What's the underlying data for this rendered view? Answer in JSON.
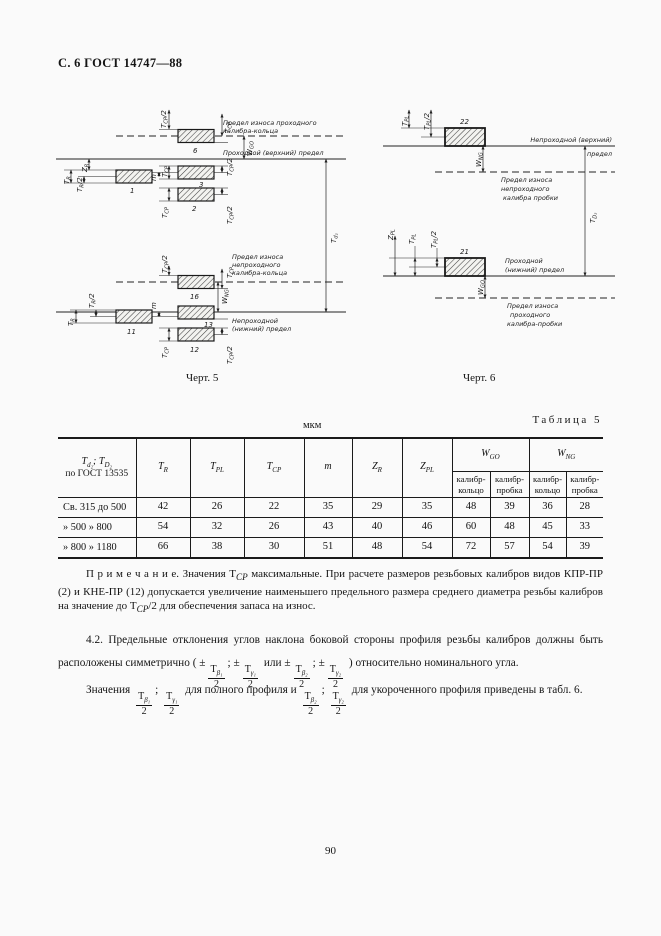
{
  "page": {
    "header": "С. 6 ГОСТ 14747—88",
    "page_number": "90"
  },
  "dims": {
    "T": "T",
    "Z": "Z",
    "W": "W",
    "m": "m",
    "R": "R",
    "PL": "PL",
    "CP": "CP",
    "GO": "GO",
    "NG": "NG",
    "d2": "d₂",
    "D2": "D₂",
    "half": "/2"
  },
  "fig5": {
    "caption": "Черт. 5",
    "wear_go_ring": [
      "Предел износа проходного",
      "калибра-кольца"
    ],
    "go_upper": "Проходной (верхний) предел",
    "wear_ng_ring": [
      "Предел износа",
      "непроходного",
      "калибра-кольца"
    ],
    "ng_lower": [
      "Непроходной",
      "(нижний) предел"
    ],
    "boxes": {
      "b1": "1",
      "b2": "2",
      "b3": "3",
      "b6": "6",
      "b11": "11",
      "b12": "12",
      "b13": "13",
      "b16": "16"
    }
  },
  "fig6": {
    "caption": "Черт. 6",
    "ng_upper": [
      "Непроходной (верхний)",
      "предел"
    ],
    "wear_ng_plug": [
      "Предел износа",
      "непроходного",
      "калибра пробки"
    ],
    "go_lower": [
      "Проходной",
      "(нижний) предел"
    ],
    "wear_go_plug": [
      "Предел износа",
      "проходного",
      "калибра-пробки"
    ],
    "boxes": {
      "b21": "21",
      "b22": "22"
    }
  },
  "table": {
    "units": "мкм",
    "caption": "Таблица 5",
    "col1": {
      "l1a": "T",
      "l1b": "d₂",
      "l1c": "; T",
      "l1d": "D₂",
      "l2": "по ГОСТ 13535"
    },
    "cols": [
      {
        "m": "Т",
        "s": "R"
      },
      {
        "m": "Т",
        "s": "PL"
      },
      {
        "m": "Т",
        "s": "СР"
      },
      {
        "m": "m",
        "s": ""
      },
      {
        "m": "Z",
        "s": "R"
      },
      {
        "m": "Z",
        "s": "PL"
      }
    ],
    "wgo": {
      "m": "W",
      "s": "GO"
    },
    "wng": {
      "m": "W",
      "s": "NG"
    },
    "sub_ring": [
      "калибр-",
      "кольцо"
    ],
    "sub_plug": [
      "калибр-",
      "пробка"
    ],
    "rows": [
      {
        "range": "Св. 315 до 500",
        "values": [
          "42",
          "26",
          "22",
          "35",
          "29",
          "35",
          "48",
          "39",
          "36",
          "28"
        ]
      },
      {
        "range": "» 500 » 800",
        "values": [
          "54",
          "32",
          "26",
          "43",
          "40",
          "46",
          "60",
          "48",
          "45",
          "33"
        ]
      },
      {
        "range": "» 800 » 1180",
        "values": [
          "66",
          "38",
          "30",
          "51",
          "48",
          "54",
          "72",
          "57",
          "54",
          "39"
        ]
      }
    ]
  },
  "note": {
    "label": "П р и м е ч а н и е.",
    "n1": " Значения Т",
    "s1": "СР",
    "n2": " максимальные. При расчете размеров резьбовых калибров видов КПР-ПР (2) и КНЕ-ПР (12) допускается увеличение наименьшего предельного размера среднего диаметра резьбы калибров на значение до Т",
    "s2": "СР",
    "n3": "/2 для обеспечения запаса на износ."
  },
  "sym": {
    "T": "Т",
    "two": "2",
    "b1": "β₁",
    "g1": "γ₁",
    "b2": "β₂",
    "g2": "γ₂"
  },
  "para42": {
    "p1": "4.2. Предельные отклонения углов наклона боковой стороны профиля резьбы калибров должны быть расположены симметрично ( ±",
    "p2": ";  ±",
    "p3": " или  ±",
    "p4": ";  ±",
    "p5": " ) относительно номинального угла."
  },
  "para_last": {
    "p1": "Значения ",
    "p2": ";  ",
    "p3": " для полного профиля и  ",
    "p4": ";  ",
    "p5": " для укороченного профиля приведены в табл. 6."
  }
}
